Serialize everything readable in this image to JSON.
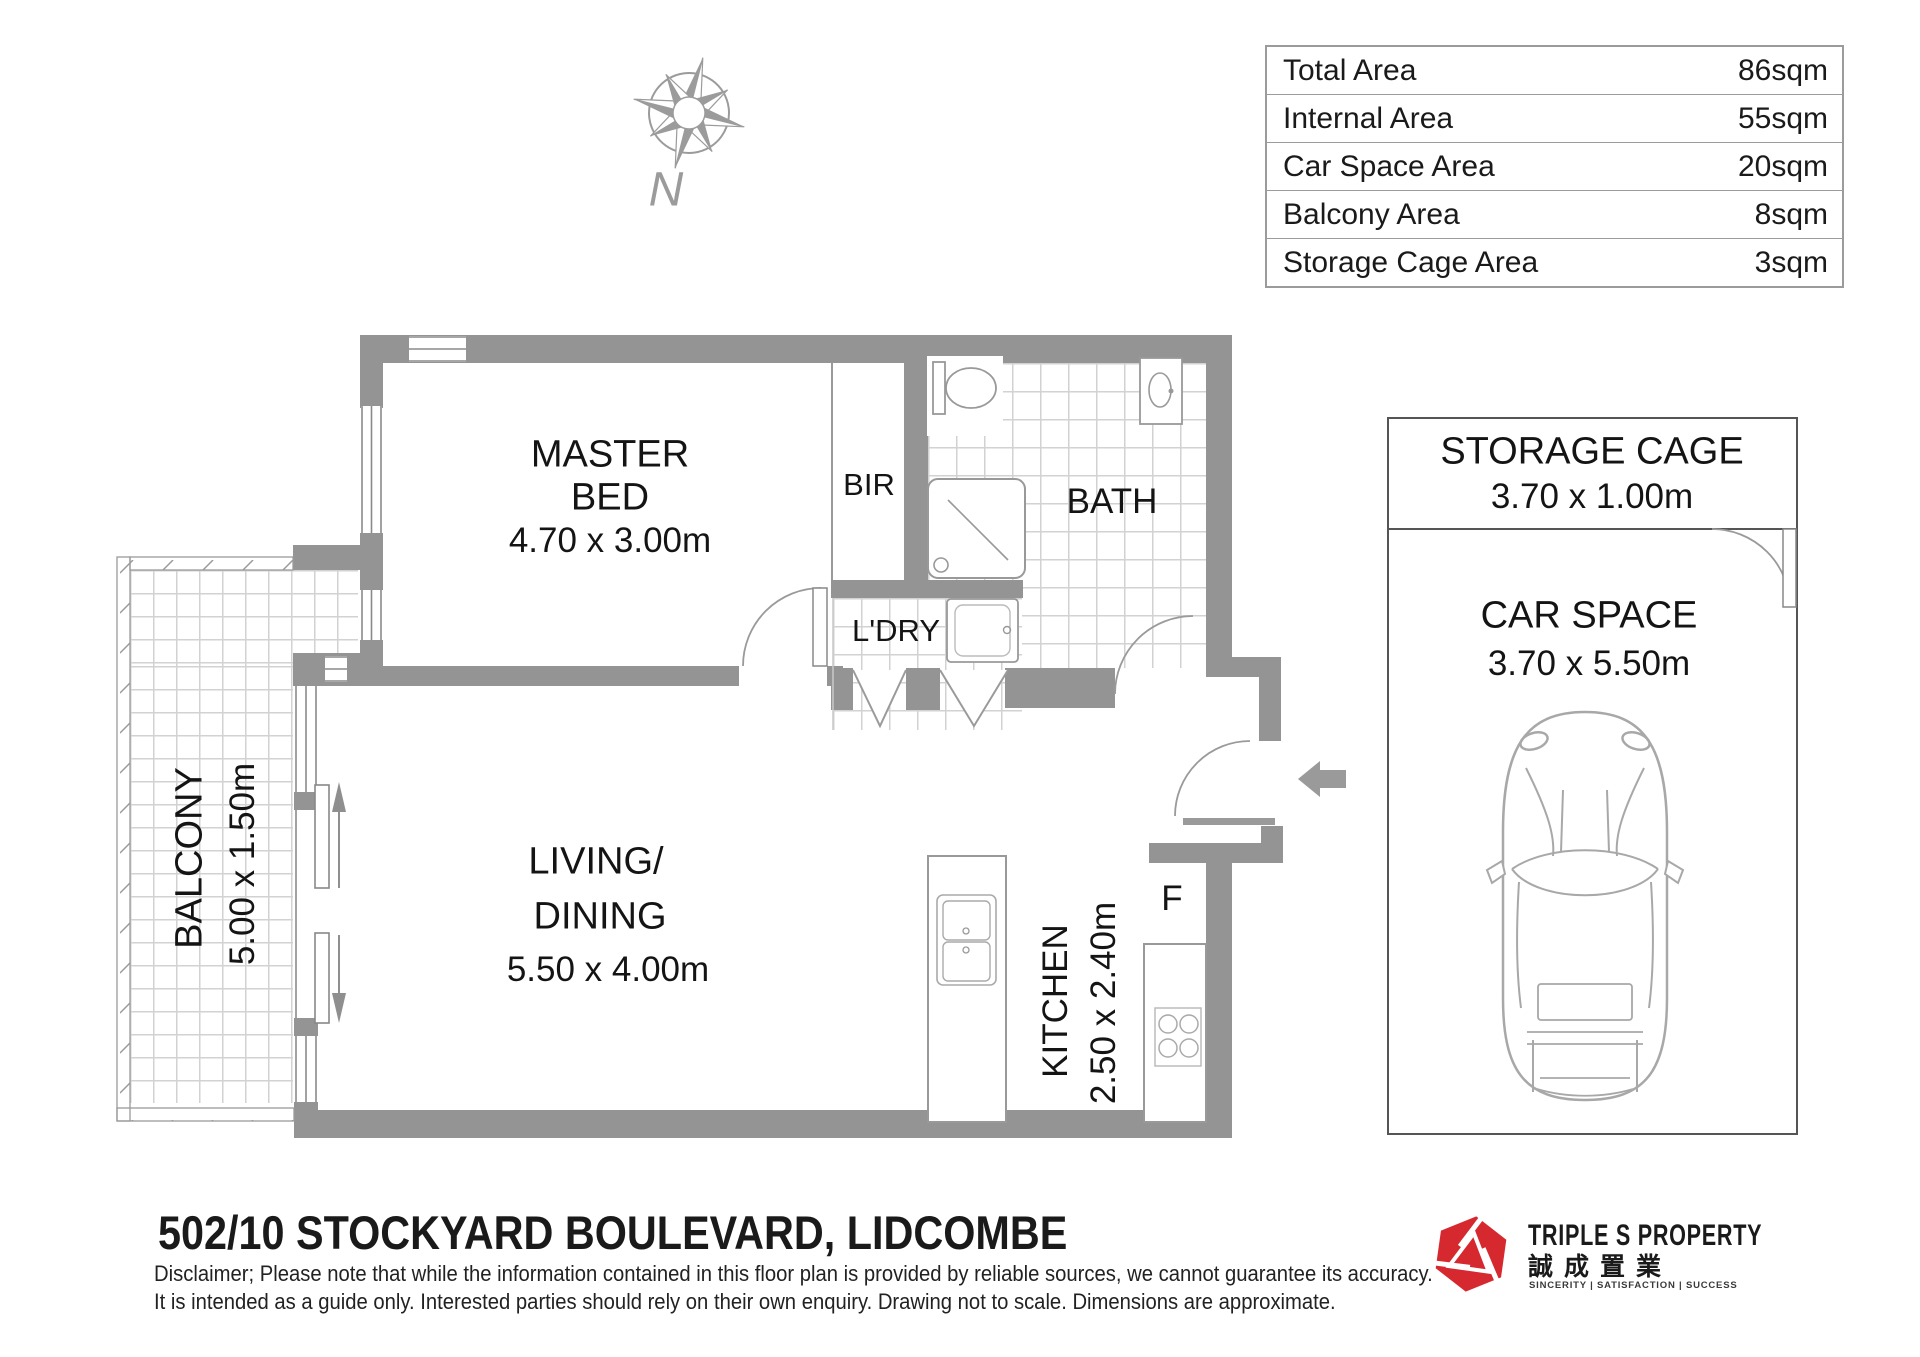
{
  "area_table": {
    "rows": [
      {
        "label": "Total Area",
        "value": "86sqm"
      },
      {
        "label": "Internal Area",
        "value": "55sqm"
      },
      {
        "label": "Car Space Area",
        "value": "20sqm"
      },
      {
        "label": "Balcony Area",
        "value": "8sqm"
      },
      {
        "label": "Storage Cage Area",
        "value": "3sqm"
      }
    ]
  },
  "compass": {
    "north_label": "N"
  },
  "rooms": {
    "master_bed": {
      "line1": "MASTER",
      "line2": "BED",
      "dims": "4.70 x 3.00m"
    },
    "bir": {
      "label": "BIR"
    },
    "bath": {
      "label": "BATH"
    },
    "ldry": {
      "label": "L'DRY"
    },
    "living": {
      "line1": "LIVING/",
      "line2": "DINING",
      "dims": "5.50 x 4.00m"
    },
    "kitchen": {
      "label": "KITCHEN",
      "dims": "2.50 x 2.40m"
    },
    "fridge": {
      "label": "F"
    },
    "balcony": {
      "label": "BALCONY",
      "dims": "5.00 x 1.50m"
    },
    "storage_cage": {
      "label": "STORAGE CAGE",
      "dims": "3.70 x 1.00m"
    },
    "car_space": {
      "label": "CAR SPACE",
      "dims": "3.70 x 5.50m"
    }
  },
  "footer": {
    "address": "502/10 STOCKYARD BOULEVARD, LIDCOMBE",
    "disclaimer_line1": "Disclaimer; Please note that while the information contained in this floor plan is provided by reliable sources, we cannot guarantee its accuracy.",
    "disclaimer_line2": "It is intended as a guide only. Interested parties should rely on their own enquiry. Drawing not to scale. Dimensions are approximate."
  },
  "logo": {
    "company": "TRIPLE S PROPERTY",
    "chinese": "誠成置業",
    "tagline": "SINCERITY | SATISFACTION | SUCCESS",
    "brand_color": "#d5292f"
  },
  "colors": {
    "wall": "#949494",
    "tile_line": "#d2d2d2",
    "fixture_stroke": "#9a9a9a",
    "text": "#141414"
  }
}
